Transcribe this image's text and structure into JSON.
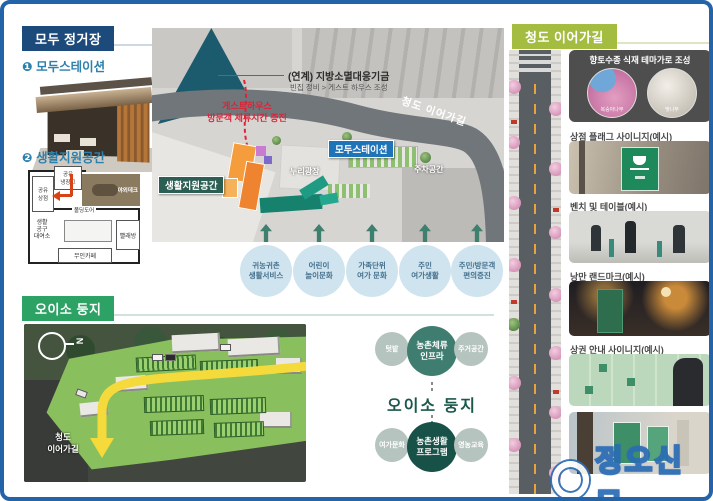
{
  "colors": {
    "border_blue": "#2563a8",
    "navy_header": "#1b4a7b",
    "teal_item": "#2e80ad",
    "green_header": "#2ca365",
    "lime_header": "#a4bc3f",
    "station_label_bg": "#1f74b8",
    "life_label_bg": "#2c5f53",
    "effect_circle_bg": "#cfe4ee",
    "arrow_teal": "#3f7f6e",
    "red_note": "#e02237",
    "yellow_road": "#f4da3a",
    "watermark_blue": "#2a6cb5"
  },
  "modu": {
    "header": "모두 정거장",
    "item1_num": "❶",
    "item1_label": "모두스테이션",
    "item2_num": "❷",
    "item2_label": "생활지원공간",
    "floorplan": {
      "fridge": "공유\n냉장고",
      "shop": "공유\n상점",
      "deck": "야외데크",
      "door": "폴딩도어",
      "tools": "생활\n공구\n대여소",
      "cafe": "무인카페",
      "laundry": "빨래방"
    }
  },
  "map": {
    "fund_title": "(연계) 지방소멸대응기금",
    "fund_sub": "빈집 정비 > 게스트 하우스 조성",
    "guesthouse_note": "게스트하우스\n방문객 체류시간 증진",
    "road_label": "청도 이어가길",
    "station_label": "모두스테이션",
    "life_label": "생활지원공간",
    "plaza_label": "누리광장",
    "parking_label": "주차공간",
    "effects": [
      "귀농귀촌\n생활서비스",
      "어린이\n놀이문화",
      "가족단위\n여가 문화",
      "주민\n여가생활",
      "주민/방문객\n편의증진"
    ]
  },
  "oiso": {
    "header": "오이소 둥지",
    "north": "N",
    "road_label": "청도\n이어가길",
    "center": "오이소 둥지",
    "infra": "농촌체류\n인프라",
    "garden": "텃밭",
    "housing": "주거공간",
    "program": "농촌생활\n프로그램",
    "leisure": "여가문화",
    "education": "영농교육"
  },
  "street": {
    "header": "청도 이어가길",
    "card1_title": "향토수종 식재 테마가로 조성",
    "tree1": "복숭아나무",
    "tree2": "벚나무",
    "card2": "상점 플래그 사이니지(예시)",
    "card3": "벤치 및 테이블(예시)",
    "card4": "낭만 랜드마크(예시)",
    "card5": "상권 안내 사이니지(예시)"
  },
  "watermark": "정오신문"
}
